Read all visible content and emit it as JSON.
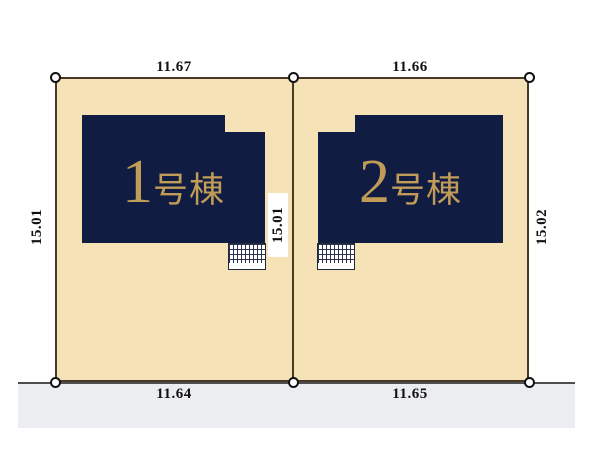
{
  "plan_title": "2棟区画図",
  "units": [
    {
      "number": "1",
      "suffix": "号棟",
      "name": "1号棟"
    },
    {
      "number": "2",
      "suffix": "号棟",
      "name": "2号棟"
    }
  ],
  "dimensions": {
    "top_left": "11.67",
    "top_right": "11.66",
    "bottom_left": "11.64",
    "bottom_right": "11.65",
    "side_left": "15.01",
    "side_middle": "15.01",
    "side_right": "15.02"
  },
  "colors": {
    "parcel_fill": "#f5e2b6",
    "parcel_line": "#473827",
    "building_fill": "#101c42",
    "unit_text": "#c09c58",
    "road_fill": "#ecedf1",
    "road_line": "#4e4e4e",
    "dimension_text": "#111111"
  },
  "icons": {
    "survey_marker": "small white circle with black outline",
    "hatch_area": "cross-hatched entrance/parking grid"
  }
}
